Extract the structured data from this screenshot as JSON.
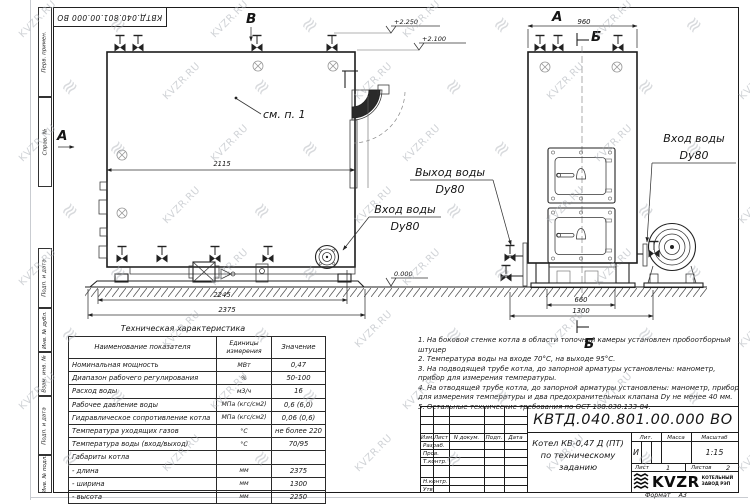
{
  "watermark": {
    "text": "KVZR.RU",
    "symbol": "≋"
  },
  "corner_stamp": {
    "doc_number": "КВТД.040.801.00.000  ВО"
  },
  "margin_labels": [
    "Перв. примен.",
    "Справ. №",
    "Подп. и дата",
    "Инв. № дубл.",
    "Взам. инв. №",
    "Подп. и дата",
    "Инв. № подл."
  ],
  "drawing": {
    "letters": {
      "side_view": "А",
      "top_view": "В",
      "front_view": "А",
      "section": "Б"
    },
    "elevations": {
      "valves_top": "+2.250",
      "boiler_top": "+2.100",
      "ground": "0.000"
    },
    "dims": {
      "side_inner_width": "2115",
      "side_base_width": "2245",
      "side_overall_width": "2375",
      "front_top_width": "960",
      "front_base_width": "660",
      "front_overall_width": "1300"
    },
    "callout": "см. п. 1",
    "water_outlet": {
      "line1": "Выход воды",
      "line2": "Dy80"
    },
    "water_inlet": {
      "line1": "Вход воды",
      "line2": "Dy80"
    }
  },
  "spec_table": {
    "title": "Техническая характеристика",
    "col_name": "Наименование показателя",
    "col_units": "Единицы измерения",
    "col_value": "Значение",
    "rows": [
      [
        "Номинальная мощность",
        "МВт",
        "0,47"
      ],
      [
        "Диапазон рабочего регулирования",
        "%",
        "50-100"
      ],
      [
        "Расход воды",
        "м3/ч",
        "16"
      ],
      [
        "Рабочее давление воды",
        "МПа (кгс/см2)",
        "0,6 (6,0)"
      ],
      [
        "Гидравлическое сопротивление котла",
        "МПа (кгс/см2)",
        "0,06 (0,6)"
      ],
      [
        "Температура уходящих газов",
        "°С",
        "не более 220"
      ],
      [
        "Температура воды (вход/выход)",
        "°С",
        "70/95"
      ],
      [
        "Габариты котла",
        "",
        ""
      ],
      [
        "- длина",
        "мм",
        "2375"
      ],
      [
        "- ширина",
        "мм",
        "1300"
      ],
      [
        "- высота",
        "мм",
        "2250"
      ]
    ]
  },
  "notes": [
    "1. На боковой стенке котла в области топочной камеры установлен пробоотборный штуцер",
    "2. Температура воды на входе 70°С, на выходе 95°С.",
    "3. На подводящей трубе котла, до запорной арматуры установлены: манометр, прибор для измерения температуры.",
    "4. На отводящей трубе котла, до запорной арматуры установлены: манометр, прибор для измерения температуры и два предохранительных клапана Dу не менее 40 мм.",
    "5. Остальные технические требования по ОСТ 108.030.133-84."
  ],
  "title_block": {
    "doc_number": "КВТД.040.801.00.000  ВО",
    "product_line1": "Котел  КВ-0,47 Д (ПТ)",
    "product_line2": "по техническому заданию",
    "col_izm": "Изм.",
    "col_list": "Лист",
    "col_doc": "N докум.",
    "col_podp": "Подп.",
    "col_data": "Дата",
    "row_razrab": "Разраб.",
    "row_prov": "Пров.",
    "row_tkontr": "Т.контр.",
    "row_nkontr": "Н.контр.",
    "row_utv": "Утв.",
    "lit_label": "Лит.",
    "mass_label": "Масса",
    "scale_label": "Масштаб",
    "lit_value": "И",
    "scale_value": "1:15",
    "sheet_label": "Лист",
    "sheet_value": "1",
    "sheets_label": "Листов",
    "sheets_value": "2",
    "logo_text": "KVZR",
    "logo_sub1": "КОТЕЛЬНЫЙ",
    "logo_sub2": "ЗАВОД РЭП",
    "format_label": "Формат",
    "format_value": "А3"
  }
}
